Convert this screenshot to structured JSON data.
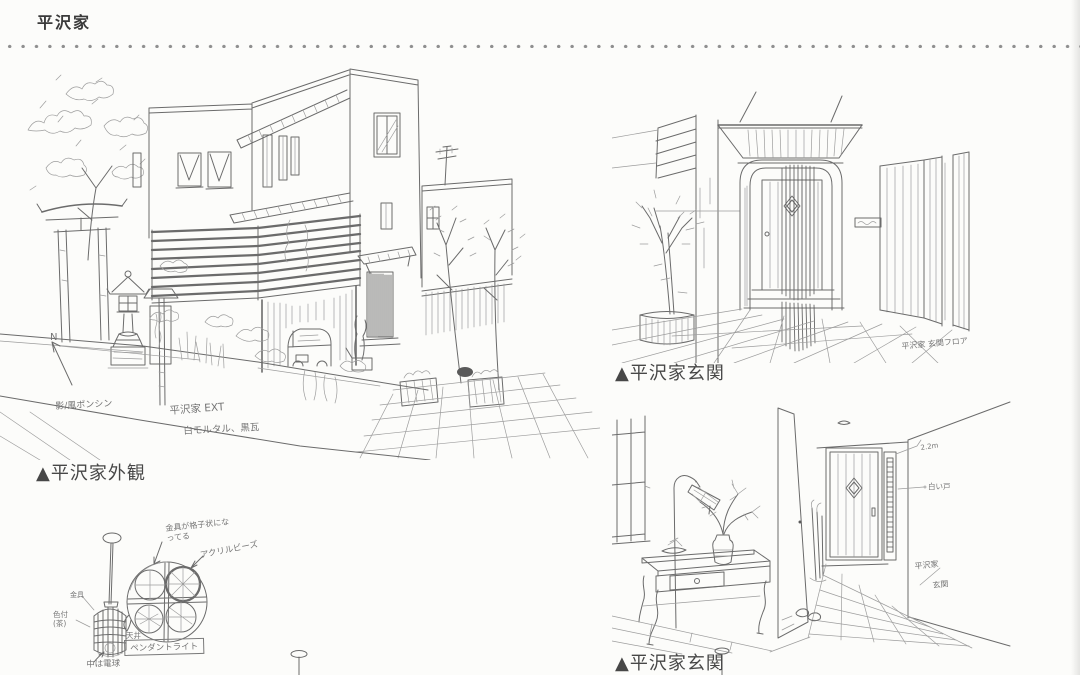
{
  "page": {
    "title": "平沢家"
  },
  "captions": {
    "exterior": "▲平沢家外観",
    "gate": "▲平沢家玄関",
    "genkan": "▲平沢家玄関"
  },
  "annotations": {
    "exterior": {
      "compass": "N",
      "shrine_note": "影/風ポンシン",
      "title_note": "平沢家 EXT",
      "material_note": "白モルタル、黒瓦"
    },
    "gate": {
      "location_note": "平沢家 玄関フロア"
    },
    "genkan": {
      "height_note": "2.2m",
      "door_note": "白い戸",
      "location_note_1": "平沢家",
      "location_note_2": "玄関"
    },
    "pendant": {
      "lattice_note": "金具が格子状になってる",
      "beads_note": "アクリルビーズ",
      "fitting_note": "金具",
      "color_note": "色付(茶)",
      "ceiling_note": "天井",
      "label": "ペンダントライト",
      "bulb_note": "中は電球"
    }
  },
  "colors": {
    "ink": "#6b6b6b",
    "paper": "#fcfcfa",
    "title": "#3a3a3a"
  }
}
